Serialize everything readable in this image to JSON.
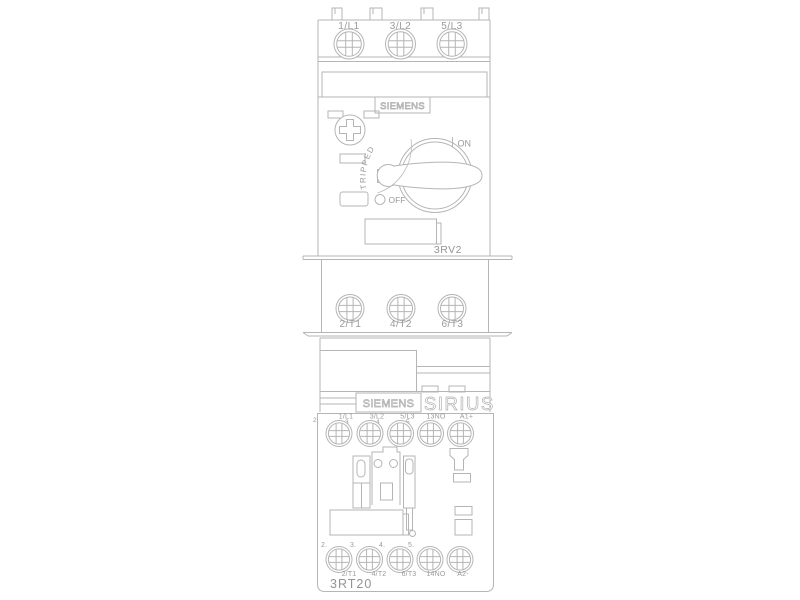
{
  "colors": {
    "line": "#b5b5b5",
    "text": "#9a9a9a",
    "background": "#ffffff"
  },
  "breaker": {
    "brand": "SIEMENS",
    "model": "3RV2",
    "input_terminals": [
      "1/L1",
      "3/L2",
      "5/L3"
    ],
    "output_terminals": [
      "2/T1",
      "4/T2",
      "6/T3"
    ],
    "switch": {
      "tripped": "TRIPPED",
      "on": "ON",
      "off": "OFF"
    }
  },
  "contactor": {
    "brand": "SIEMENS",
    "series": "SIRIUS",
    "model": "3RT20",
    "input_terminals": [
      "1/L1",
      "3/L2",
      "5/L3",
      "13NO",
      "A1+"
    ],
    "output_terminals": [
      "2/T1",
      "4/T2",
      "6/T3",
      "14NO",
      "A2-"
    ],
    "top_markers": [
      "2",
      "3",
      "4",
      "5"
    ],
    "bottom_markers": [
      "2.",
      "3.",
      "4.",
      "5."
    ]
  }
}
